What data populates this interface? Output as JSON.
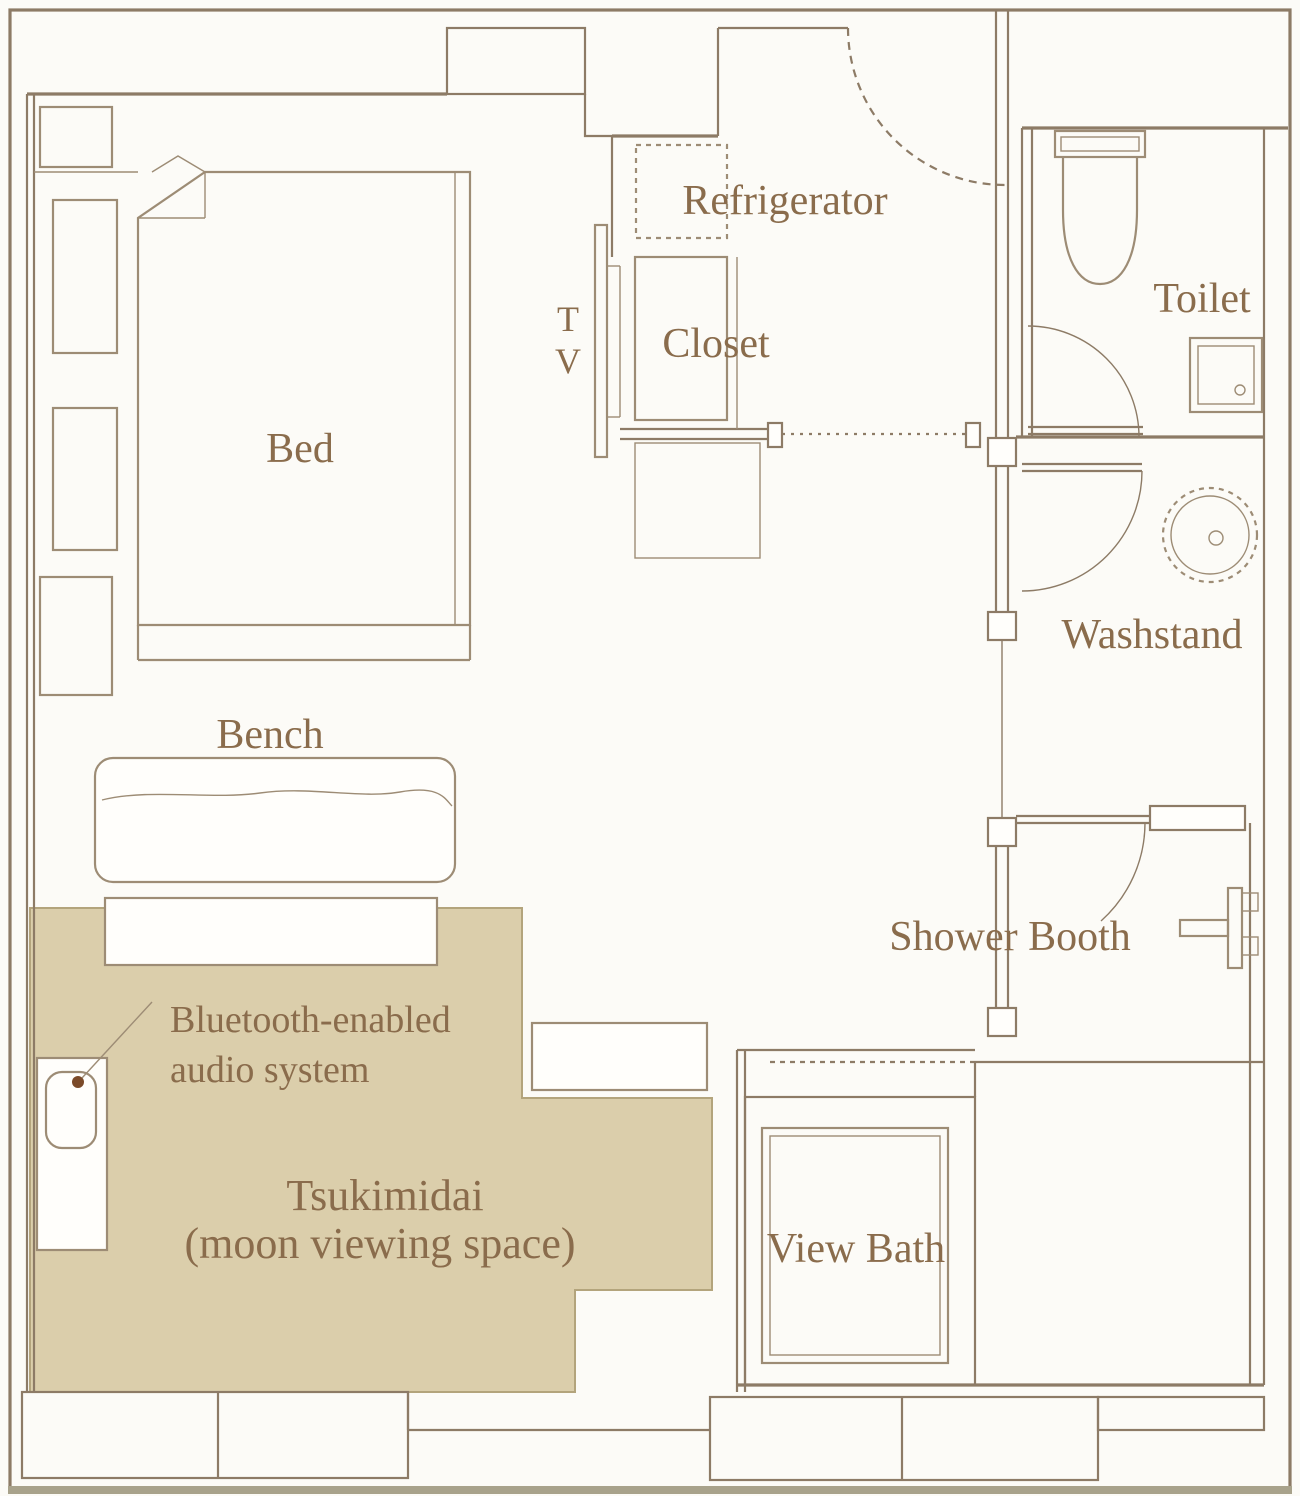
{
  "colors": {
    "wall": "#8d7b66",
    "furniture": "#9d8c75",
    "text": "#8a6c4c",
    "beige_fill": "#dbceab",
    "beige_border": "#b3a47c",
    "background": "#fcfbf7",
    "trim": "#a8a28b",
    "dot": "#7b4a28"
  },
  "labels": {
    "bed": "Bed",
    "bench": "Bench",
    "tv_line1": "T",
    "tv_line2": "V",
    "refrigerator": "Refrigerator",
    "closet": "Closet",
    "toilet": "Toilet",
    "washstand": "Washstand",
    "shower_booth": "Shower Booth",
    "view_bath": "View Bath",
    "bluetooth_line1": "Bluetooth-enabled",
    "bluetooth_line2": "audio system",
    "tsukimidai_line1": "Tsukimidai",
    "tsukimidai_line2": "(moon viewing space)"
  }
}
